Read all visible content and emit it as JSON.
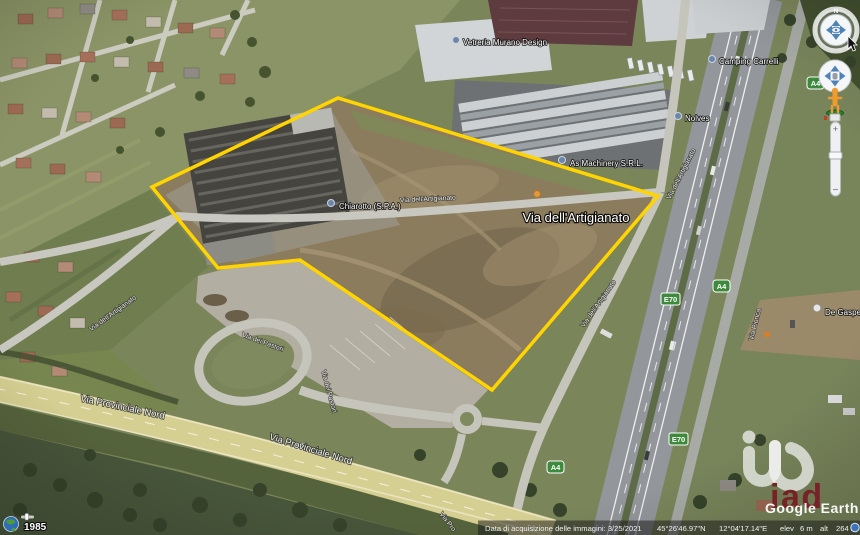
{
  "app": {
    "name": "Google Earth"
  },
  "map": {
    "pois": [
      {
        "label": "Vetreria Murano Design"
      },
      {
        "label": "Camping Carrelli"
      },
      {
        "label": "Nolves"
      },
      {
        "label": "As Machinery S.R.L."
      },
      {
        "label": "Chiarotto (S.P.A.)"
      },
      {
        "label": "De Gasperi"
      }
    ],
    "streets": [
      {
        "label": "Via dell'Artigianato"
      },
      {
        "label": "Via dell'Artigianato"
      },
      {
        "label": "Via dell'Artigianato"
      },
      {
        "label": "Via dell'Artigianato"
      },
      {
        "label": "Via dell'Artigianato"
      },
      {
        "label": "Via dei Pastori"
      },
      {
        "label": "Via dei Pastori"
      },
      {
        "label": "Via Provinciale Nord"
      },
      {
        "label": "Via Provinciale Nord"
      },
      {
        "label": "Via Pro"
      },
      {
        "label": "Via Pionca"
      }
    ],
    "road_badges": [
      {
        "label": "A4"
      },
      {
        "label": "A4"
      },
      {
        "label": "E70"
      },
      {
        "label": "E70"
      },
      {
        "label": "A4"
      }
    ]
  },
  "navigation": {
    "north_label": "N",
    "zoom_in": "+",
    "zoom_out": "−"
  },
  "history": {
    "year": "1985"
  },
  "status_bar": {
    "acquisition": "Data di acquisizione delle immagini: 3/25/2021",
    "latitude": "45°26'46.97\"N",
    "longitude": "12°04'17.14\"E",
    "elev_label": "elev",
    "elev_value": "6 m",
    "alt_label": "alt",
    "alt_value": "264 m"
  },
  "watermarks": {
    "agency": "iad",
    "earth_logo": "Google Earth"
  },
  "colors": {
    "parcel": "#ffd400",
    "badge_green": "#3d8a3d"
  }
}
